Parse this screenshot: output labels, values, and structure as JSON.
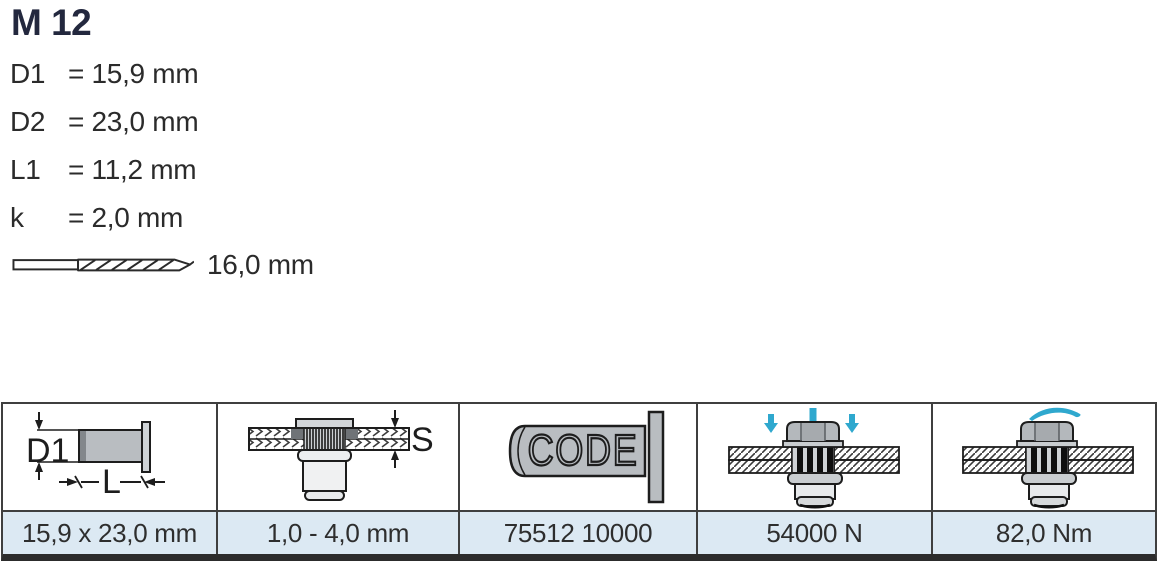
{
  "title": "M 12",
  "specs": [
    {
      "label": "D1",
      "value": "= 15,9 mm"
    },
    {
      "label": "D2",
      "value": "= 23,0 mm"
    },
    {
      "label": "L1",
      "value": "= 11,2 mm"
    },
    {
      "label": "k",
      "value": "= 2,0 mm"
    }
  ],
  "drill": {
    "icon": "drill-bit-icon",
    "value": "16,0 mm"
  },
  "table": {
    "columns": [
      {
        "icon": "rivet-dimensions-icon",
        "labels": {
          "diameter": "D1",
          "length": "L"
        },
        "value": "15,9 x 23,0 mm"
      },
      {
        "icon": "grip-range-icon",
        "labels": {
          "grip": "S"
        },
        "value": "1,0 - 4,0 mm"
      },
      {
        "icon": "code-stamp-icon",
        "labels": {
          "stamp": "CODE"
        },
        "value": "75512 10000"
      },
      {
        "icon": "pull-out-force-icon",
        "value": "54000 N"
      },
      {
        "icon": "tightening-torque-icon",
        "value": "82,0 Nm"
      }
    ]
  },
  "colors": {
    "title_text": "#23283e",
    "body_text": "#2b2b2b",
    "table_border": "#3f3f3f",
    "value_row_bg": "#dce9f3",
    "icon_gray": "#b9bdc1",
    "arrow_blue": "#2fa8ce"
  }
}
